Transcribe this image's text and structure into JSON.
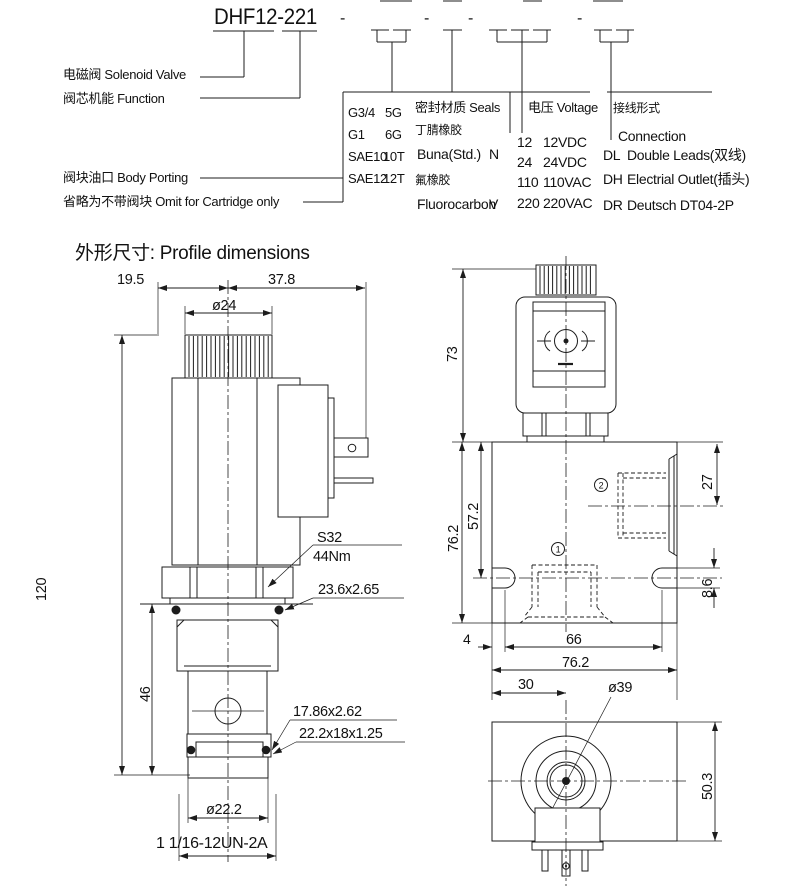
{
  "model": {
    "code": "DHF12-221",
    "dash": "-"
  },
  "legend": {
    "solenoid": "电磁阀 Solenoid Valve",
    "function": "阀芯机能 Function",
    "body_porting": "阀块油口 Body Porting",
    "omit": "省略为不带阀块 Omit for Cartridge only"
  },
  "porting": {
    "rows": [
      [
        "G3/4",
        "5G"
      ],
      [
        "G1",
        "6G"
      ],
      [
        "SAE10",
        "10T"
      ],
      [
        "SAE12",
        "12T"
      ]
    ]
  },
  "seals": {
    "title": "密封材质 Seals",
    "rows": [
      {
        "cn": "丁腈橡胶",
        "en": "Buna(Std.)",
        "code": "N"
      },
      {
        "cn": "氟橡胶",
        "en": "Fluorocarbon",
        "code": "V"
      }
    ]
  },
  "voltage": {
    "title": "电压 Voltage",
    "rows": [
      [
        "12",
        "12VDC"
      ],
      [
        "24",
        "24VDC"
      ],
      [
        "110",
        "110VAC"
      ],
      [
        "220",
        "220VAC"
      ]
    ]
  },
  "connection": {
    "title": "接线形式",
    "subtitle": "Connection",
    "rows": [
      [
        "DL",
        "Double Leads(双线)"
      ],
      [
        "DH",
        "Electrial Outlet(插头)"
      ],
      [
        "DR",
        "Deutsch DT04-2P"
      ]
    ]
  },
  "section_title": "外形尺寸: Profile dimensions",
  "dims_left": {
    "width_left": "19.5",
    "width_right": "37.8",
    "coil_dia": "ø24",
    "total_height": "120",
    "cartridge_height": "46",
    "wrench": "S32",
    "torque": "44Nm",
    "seal_top": "23.6x2.65",
    "seal_mid": "17.86x2.62",
    "backup_ring": "22.2x18x1.25",
    "stem_dia": "ø22.2",
    "thread": "1 1/16-12UN-2A"
  },
  "dims_right": {
    "coil_height": "73",
    "block_height": "76.2",
    "port_depth": "57.2",
    "port2_height": "27",
    "slot_width": "8.6",
    "edge_offset": "4",
    "hole_spacing": "66",
    "block_width": "76.2",
    "coil_center": "30",
    "coil_dia": "ø39",
    "block_depth": "50.3"
  },
  "ports": {
    "port1": "1",
    "port2": "2"
  }
}
